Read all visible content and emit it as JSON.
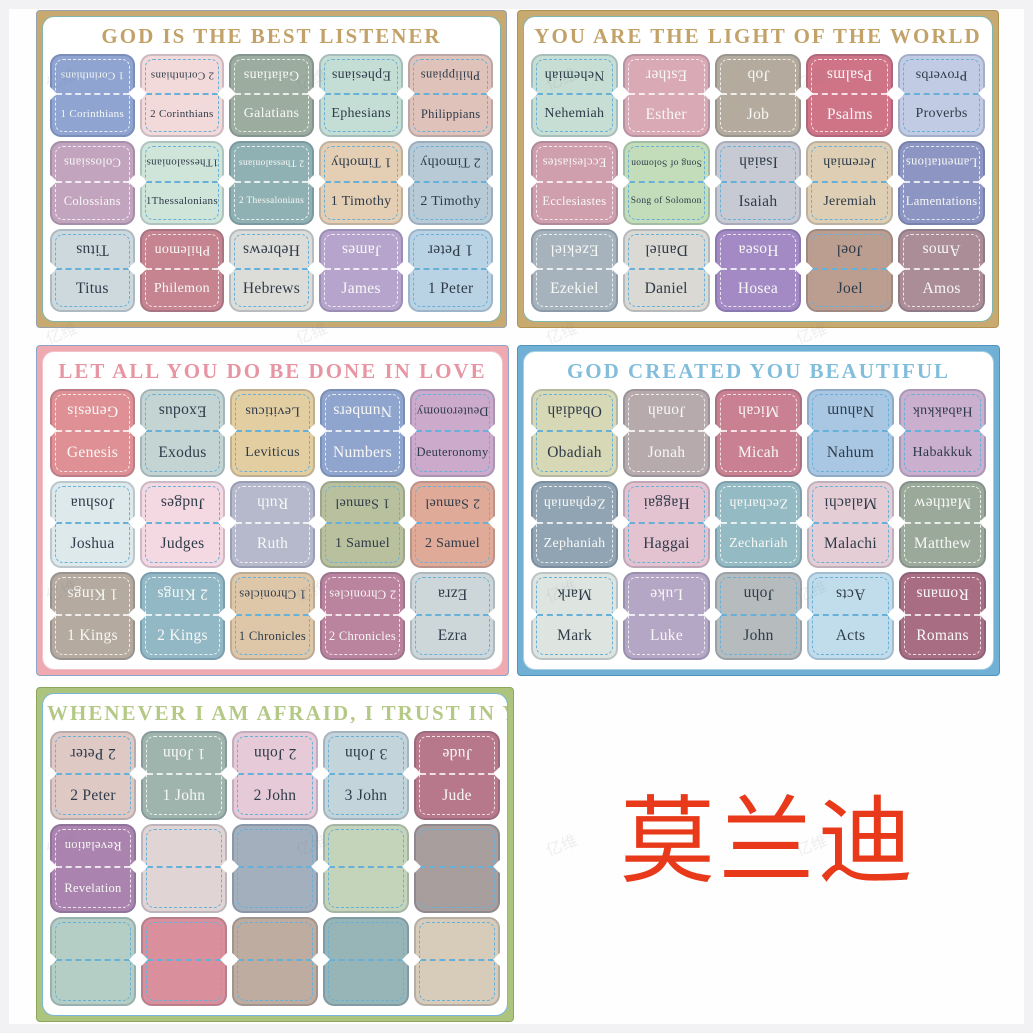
{
  "brand_text": {
    "label": "莫兰迪",
    "color": "#e8391b"
  },
  "watermark": {
    "text": "亿维",
    "color": "#6d7480"
  },
  "panels": [
    {
      "title": "GOD IS THE BEST LISTENER",
      "title_color": "#c2a268",
      "border": {
        "outer": "#98a0ad",
        "band": "#c8aa71",
        "inner": "#7fb5ac"
      },
      "pos": {
        "left": 36,
        "top": 10,
        "width": 471,
        "height": 318
      },
      "tabs": [
        {
          "label": "1 Corinthians",
          "fill": "#8fa4d1",
          "text": "light"
        },
        {
          "label": "2 Corinthians",
          "fill": "#f2d9da",
          "text": "dark"
        },
        {
          "label": "Galatians",
          "fill": "#9cac9f",
          "text": "light"
        },
        {
          "label": "Ephesians",
          "fill": "#c5ded5",
          "text": "dark"
        },
        {
          "label": "Philippians",
          "fill": "#dfc3bb",
          "text": "dark"
        },
        {
          "label": "Colossians",
          "fill": "#c3a4be",
          "text": "light"
        },
        {
          "label": "1Thessalonians",
          "fill": "#d0e5da",
          "text": "dark"
        },
        {
          "label": "2 Thessalonians",
          "fill": "#90b1b4",
          "text": "light"
        },
        {
          "label": "1 Timothy",
          "fill": "#e4cfb5",
          "text": "dark"
        },
        {
          "label": "2 Timothy",
          "fill": "#b9cad7",
          "text": "dark"
        },
        {
          "label": "Titus",
          "fill": "#cdd9dd",
          "text": "dark"
        },
        {
          "label": "Philemon",
          "fill": "#c5848f",
          "text": "light"
        },
        {
          "label": "Hebrews",
          "fill": "#dcdcd8",
          "text": "dark"
        },
        {
          "label": "James",
          "fill": "#b6a4cd",
          "text": "light"
        },
        {
          "label": "1 Peter",
          "fill": "#bad3e4",
          "text": "dark"
        }
      ]
    },
    {
      "title": "YOU ARE THE LIGHT OF THE WORLD",
      "title_color": "#c2a268",
      "border": {
        "outer": "#b09252",
        "band": "#c8aa71",
        "inner": "#7fb5ac"
      },
      "pos": {
        "left": 517,
        "top": 10,
        "width": 482,
        "height": 318
      },
      "tabs": [
        {
          "label": "Nehemiah",
          "fill": "#c6ded4",
          "text": "dark"
        },
        {
          "label": "Esther",
          "fill": "#d9a9b5",
          "text": "light"
        },
        {
          "label": "Job",
          "fill": "#b4ab9e",
          "text": "light"
        },
        {
          "label": "Psalms",
          "fill": "#cf7487",
          "text": "light"
        },
        {
          "label": "Proverbs",
          "fill": "#c2cbe4",
          "text": "dark"
        },
        {
          "label": "Ecclesiastes",
          "fill": "#d09fae",
          "text": "light"
        },
        {
          "label": "Song of Solomon",
          "fill": "#c3ddba",
          "text": "dark"
        },
        {
          "label": "Isaiah",
          "fill": "#c7c9d3",
          "text": "dark"
        },
        {
          "label": "Jeremiah",
          "fill": "#decfb4",
          "text": "dark"
        },
        {
          "label": "Lamentations",
          "fill": "#8d95c2",
          "text": "light"
        },
        {
          "label": "Ezekiel",
          "fill": "#a6b3bc",
          "text": "light"
        },
        {
          "label": "Daniel",
          "fill": "#dad9d3",
          "text": "dark"
        },
        {
          "label": "Hosea",
          "fill": "#a38ac5",
          "text": "light"
        },
        {
          "label": "Joel",
          "fill": "#bb9e90",
          "text": "dark"
        },
        {
          "label": "Amos",
          "fill": "#aa8d97",
          "text": "light"
        }
      ]
    },
    {
      "title": "LET ALL YOU DO BE DONE IN LOVE",
      "title_color": "#e795a3",
      "border": {
        "outer": "#8ba3c9",
        "band": "#eeaab0",
        "inner": "#f2c3c8"
      },
      "pos": {
        "left": 36,
        "top": 345,
        "width": 473,
        "height": 331
      },
      "tabs": [
        {
          "label": "Genesis",
          "fill": "#de9094",
          "text": "light"
        },
        {
          "label": "Exodus",
          "fill": "#c3d4d2",
          "text": "dark"
        },
        {
          "label": "Leviticus",
          "fill": "#e3cea2",
          "text": "dark"
        },
        {
          "label": "Numbers",
          "fill": "#90a5ce",
          "text": "light"
        },
        {
          "label": "Deuteronomy",
          "fill": "#cbaacb",
          "text": "dark"
        },
        {
          "label": "Joshua",
          "fill": "#dee9eb",
          "text": "dark"
        },
        {
          "label": "Judges",
          "fill": "#f4d8e2",
          "text": "dark"
        },
        {
          "label": "Ruth",
          "fill": "#b6b8cc",
          "text": "light"
        },
        {
          "label": "1 Samuel",
          "fill": "#b9c09e",
          "text": "dark"
        },
        {
          "label": "2 Samuel",
          "fill": "#e0aa99",
          "text": "dark"
        },
        {
          "label": "1 Kings",
          "fill": "#b4aa9f",
          "text": "light"
        },
        {
          "label": "2 Kings",
          "fill": "#92b8c5",
          "text": "light"
        },
        {
          "label": "1 Chronicles",
          "fill": "#dec7a9",
          "text": "dark"
        },
        {
          "label": "2 Chronicles",
          "fill": "#ba839e",
          "text": "light"
        },
        {
          "label": "Ezra",
          "fill": "#cdd7da",
          "text": "dark"
        }
      ]
    },
    {
      "title": "GOD CREATED YOU BEAUTIFUL",
      "title_color": "#82bedc",
      "border": {
        "outer": "#4f93bc",
        "band": "#6fb0d4",
        "inner": "#a6d0e6"
      },
      "pos": {
        "left": 517,
        "top": 345,
        "width": 483,
        "height": 331
      },
      "tabs": [
        {
          "label": "Obadiah",
          "fill": "#d7d8b5",
          "text": "dark"
        },
        {
          "label": "Jonah",
          "fill": "#b6aaac",
          "text": "light"
        },
        {
          "label": "Micah",
          "fill": "#c98091",
          "text": "light"
        },
        {
          "label": "Nahum",
          "fill": "#a9c7e3",
          "text": "dark"
        },
        {
          "label": "Habakkuk",
          "fill": "#caafce",
          "text": "dark"
        },
        {
          "label": "Zephaniah",
          "fill": "#90a4b3",
          "text": "light"
        },
        {
          "label": "Haggai",
          "fill": "#e4c3d0",
          "text": "dark"
        },
        {
          "label": "Zechariah",
          "fill": "#94bac3",
          "text": "light"
        },
        {
          "label": "Malachi",
          "fill": "#e4cdd5",
          "text": "dark"
        },
        {
          "label": "Matthew",
          "fill": "#9ba99a",
          "text": "light"
        },
        {
          "label": "Mark",
          "fill": "#dee5e1",
          "text": "dark"
        },
        {
          "label": "Luke",
          "fill": "#b4a6c5",
          "text": "light"
        },
        {
          "label": "John",
          "fill": "#b6bcbe",
          "text": "dark"
        },
        {
          "label": "Acts",
          "fill": "#c1ddec",
          "text": "dark"
        },
        {
          "label": "Romans",
          "fill": "#a96d83",
          "text": "light"
        }
      ]
    },
    {
      "title": "WHENEVER I AM AFRAID, I TRUST IN YOU",
      "title_color": "#b5c987",
      "border": {
        "outer": "#8da65d",
        "band": "#adc47e",
        "inner": "#79b7d9"
      },
      "pos": {
        "left": 36,
        "top": 687,
        "width": 478,
        "height": 335
      },
      "tabs": [
        {
          "label": "2 Peter",
          "fill": "#dec9c5",
          "text": "dark"
        },
        {
          "label": "1 John",
          "fill": "#a0b4ae",
          "text": "light"
        },
        {
          "label": "2 John",
          "fill": "#e6cad7",
          "text": "dark"
        },
        {
          "label": "3 John",
          "fill": "#c3d4db",
          "text": "dark"
        },
        {
          "label": "Jude",
          "fill": "#b8788b",
          "text": "light"
        },
        {
          "label": "Revelation",
          "fill": "#aa84af",
          "text": "light"
        },
        {
          "label": "",
          "fill": "#e1d4d5",
          "text": "dark"
        },
        {
          "label": "",
          "fill": "#a4afbd",
          "text": "dark"
        },
        {
          "label": "",
          "fill": "#c3d4ba",
          "text": "dark"
        },
        {
          "label": "",
          "fill": "#a99e9e",
          "text": "dark"
        },
        {
          "label": "",
          "fill": "#b4cdc5",
          "text": "dark"
        },
        {
          "label": "",
          "fill": "#da909c",
          "text": "dark"
        },
        {
          "label": "",
          "fill": "#bdac9f",
          "text": "dark"
        },
        {
          "label": "",
          "fill": "#97b4b7",
          "text": "dark"
        },
        {
          "label": "",
          "fill": "#d7cbb9",
          "text": "dark"
        }
      ]
    }
  ]
}
